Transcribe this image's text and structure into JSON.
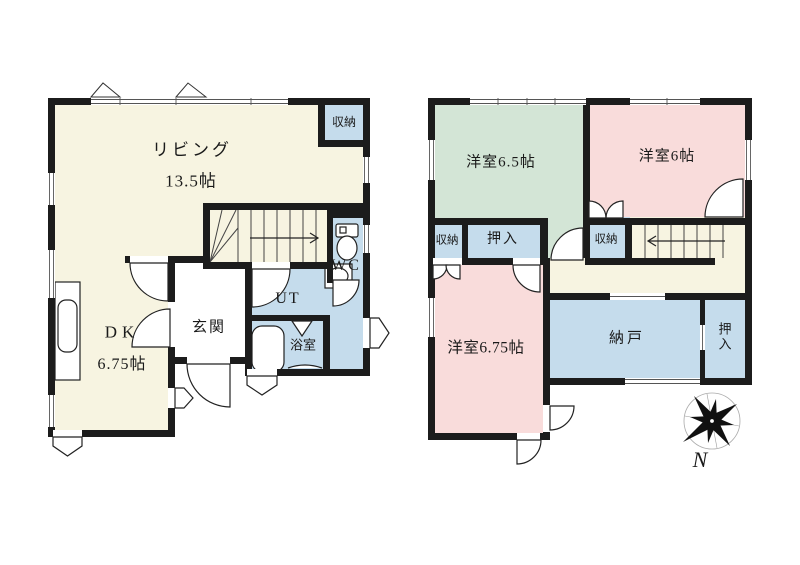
{
  "title": "2-story house floor plan",
  "floor1": {
    "living": "リビング",
    "living_size": "13.5帖",
    "storage": "収納",
    "wc": "WC",
    "ut": "UT",
    "bath": "浴室",
    "entrance": "玄関",
    "dk": "DK",
    "dk_size": "6.75帖"
  },
  "floor2": {
    "room_65": "洋室6.5帖",
    "room_6": "洋室6帖",
    "room_675": "洋室6.75帖",
    "storage_left": "収納",
    "closet": "押入",
    "storage_mid": "収納",
    "nando": "納戸",
    "closet_side": "押入",
    "compass_north": "N"
  },
  "icons": {
    "compass": "compass-rose-icon",
    "toilet": "toilet-icon",
    "bathtub": "bathtub-icon",
    "washbasin": "washbasin-icon",
    "kitchen": "kitchen-counter-icon"
  },
  "colors": {
    "wall": "#1c1c1c",
    "room_cream": "#f7f4e1",
    "room_blue": "#c5dcec",
    "room_green": "#d3e5d6",
    "room_pink": "#f9dcdb",
    "background": "#ffffff"
  }
}
